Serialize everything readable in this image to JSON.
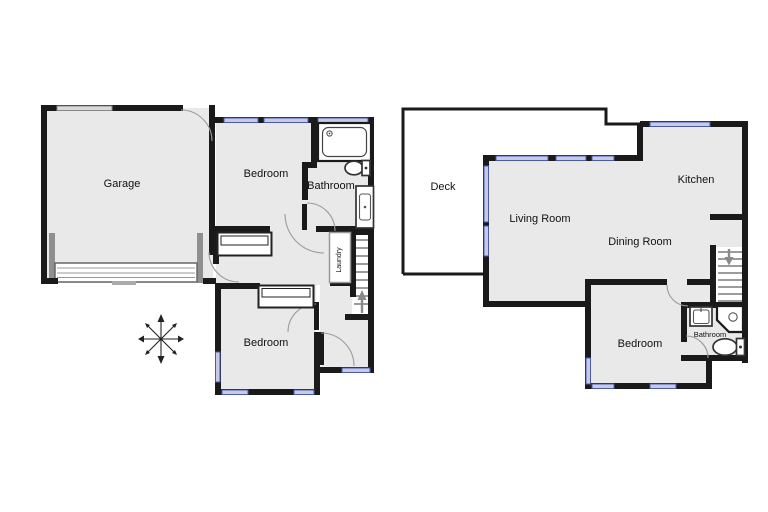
{
  "document": {
    "type": "floor-plan",
    "background": "#ffffff"
  },
  "colors": {
    "wall": "#1a1a1a",
    "room_fill": "#e9e9ea",
    "window_light": "#c6cbe2",
    "window_dark": "#4a5aa8",
    "window_gray": "#d7d9dd",
    "door_arc": "#9b9b9b",
    "stair_arrow": "#8a8a8a",
    "garage_door": "#8f8f8f",
    "text": "#111111"
  },
  "floors": [
    {
      "id": "ground-floor-plan",
      "rooms": [
        {
          "id": "garage",
          "label": "Garage"
        },
        {
          "id": "bedroom-1",
          "label": "Bedroom"
        },
        {
          "id": "bathroom-1",
          "label": "Bathroom"
        },
        {
          "id": "laundry",
          "label": "Laundry"
        },
        {
          "id": "bedroom-2",
          "label": "Bedroom"
        }
      ],
      "features": [
        "garage-door",
        "staircase-up-arrow",
        "compass-rose",
        "bathtub",
        "toilet",
        "vanity-sink"
      ]
    },
    {
      "id": "upper-floor-plan",
      "rooms": [
        {
          "id": "deck",
          "label": "Deck"
        },
        {
          "id": "living-room",
          "label": "Living Room"
        },
        {
          "id": "kitchen",
          "label": "Kitchen"
        },
        {
          "id": "dining-room",
          "label": "Dining Room"
        },
        {
          "id": "bedroom-3",
          "label": "Bedroom"
        },
        {
          "id": "bathroom-2",
          "label": "Bathroom"
        }
      ],
      "features": [
        "staircase-down-arrow",
        "corner-shower",
        "toilet",
        "sink"
      ]
    }
  ]
}
